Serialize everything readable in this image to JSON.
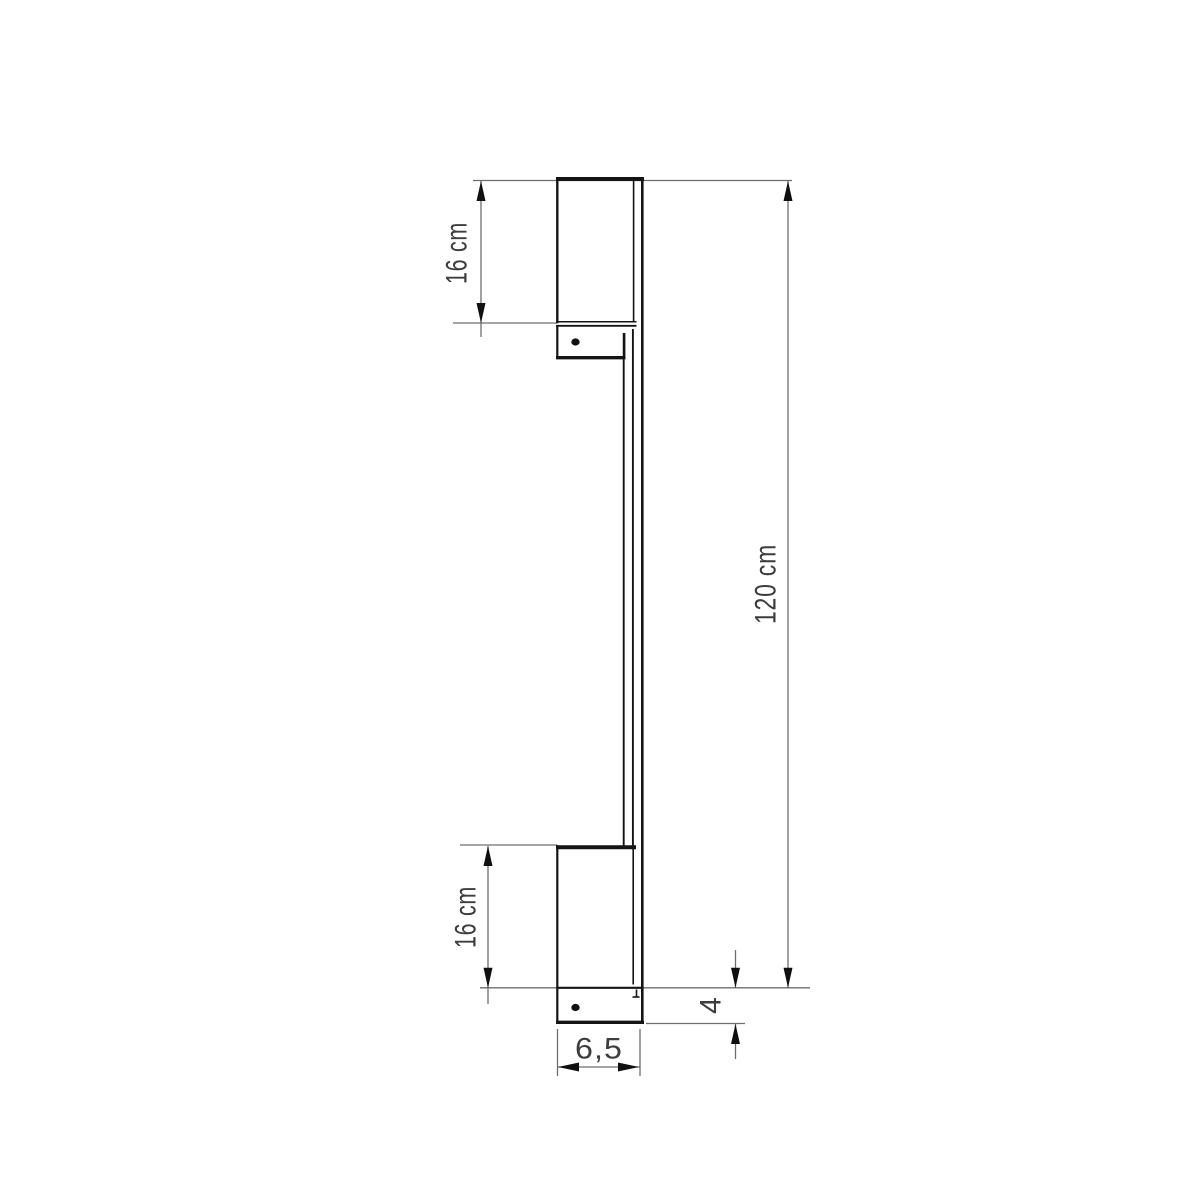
{
  "drawing": {
    "kind": "technical-dimension-diagram",
    "palette": {
      "background": "#ffffff",
      "object_line": "#141414",
      "dimension_line": "#6e6e6e",
      "arrow": "#101010",
      "label_text": "#3d3d3d"
    },
    "labels": {
      "top_section_height": "16 cm",
      "bottom_section_height": "16 cm",
      "overall_height": "120 cm",
      "base_depth": "4",
      "base_width": "6,5"
    }
  }
}
